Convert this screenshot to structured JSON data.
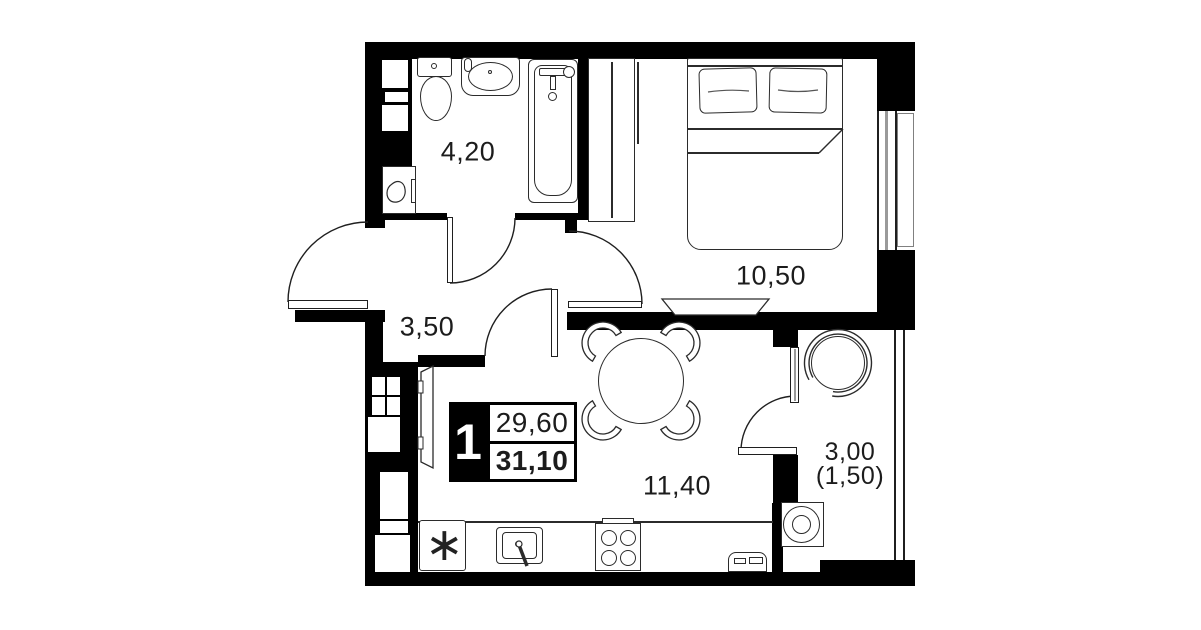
{
  "title": "Apartment floor plan",
  "colors": {
    "wall": "#000000",
    "line": "#2b2b2b",
    "muted_line": "#9a9a9a",
    "text": "#1c1c1c",
    "bg": "#ffffff"
  },
  "unit": {
    "number": "1",
    "area_living": "29,60",
    "area_total": "31,10"
  },
  "rooms": {
    "bathroom": {
      "name": "bathroom",
      "area": "4,20"
    },
    "hallway": {
      "name": "hallway",
      "area": "3,50"
    },
    "bedroom": {
      "name": "bedroom",
      "area": "10,50"
    },
    "kitchen": {
      "name": "kitchen-living room",
      "area": "11,40"
    },
    "balcony": {
      "name": "balcony",
      "area": "3,00",
      "area_reduced": "(1,50)"
    }
  },
  "icons": {
    "fridge_snowflake": "∗"
  },
  "fixtures": [
    "toilet",
    "sink",
    "bathtub",
    "washing-machine",
    "ventilation-shaft",
    "wardrobe",
    "double-bed",
    "tv",
    "dining-table",
    "chair",
    "fridge",
    "kitchen-sink",
    "stove",
    "radiator",
    "armchair",
    "washer",
    "window",
    "door"
  ]
}
